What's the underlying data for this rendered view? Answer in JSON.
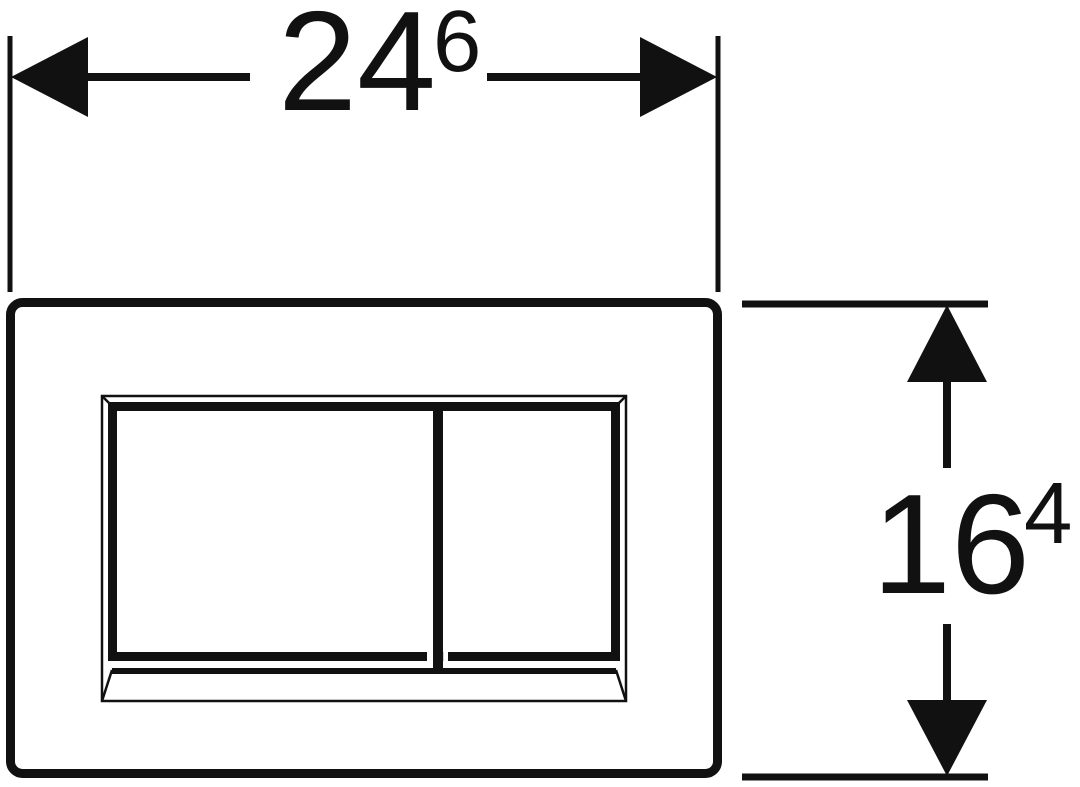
{
  "colors": {
    "background": "#ffffff",
    "line": "#111111"
  },
  "dimensions": {
    "width": {
      "main": "24",
      "sup": "6"
    },
    "height": {
      "main": "16",
      "sup": "4"
    }
  }
}
